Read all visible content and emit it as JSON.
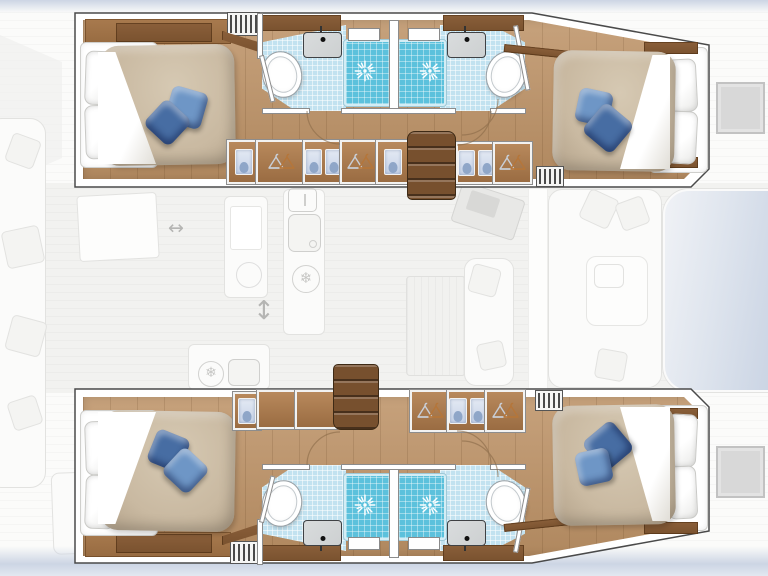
{
  "diagram": {
    "type": "yacht-floor-plan",
    "vessel": "catamaran",
    "orientation": "bow-right",
    "lower_deck": {
      "hulls": [
        {
          "side": "top",
          "cabins": [
            {
              "position": "aft",
              "bed": {
                "white_pillows": 2,
                "blue_throw_pillows": 2,
                "duvet": true
              }
            },
            {
              "position": "forward",
              "bed": {
                "white_pillows": 2,
                "blue_throw_pillows": 2,
                "duvet": true
              }
            }
          ],
          "bathrooms": [
            {
              "serves": "aft",
              "fixtures": [
                "toilet",
                "sink",
                "shower",
                "window"
              ]
            },
            {
              "serves": "forward",
              "fixtures": [
                "toilet",
                "sink",
                "shower",
                "window"
              ]
            }
          ],
          "wardrobes": {
            "hanger_lockers": 3,
            "shirt_shelves": 4
          },
          "companionway_stairs": 1,
          "louver_vents": 2
        },
        {
          "side": "bottom",
          "cabins": [
            {
              "position": "aft",
              "bed": {
                "white_pillows": 2,
                "blue_throw_pillows": 2,
                "duvet": true
              }
            },
            {
              "position": "forward",
              "bed": {
                "white_pillows": 2,
                "blue_throw_pillows": 2,
                "duvet": true
              }
            }
          ],
          "bathrooms": [
            {
              "serves": "aft",
              "fixtures": [
                "toilet",
                "sink",
                "shower",
                "window"
              ]
            },
            {
              "serves": "forward",
              "fixtures": [
                "toilet",
                "sink",
                "shower",
                "window"
              ]
            }
          ],
          "wardrobes": {
            "hanger_lockers": 3,
            "shirt_shelves": 3
          },
          "companionway_stairs": 1,
          "louver_vents": 2
        }
      ]
    },
    "main_deck_faded": {
      "cockpit": [
        "bench seating with scatter cushions",
        "cockpit table",
        "aft sunpad"
      ],
      "galley": [
        "sink unit",
        "round burner",
        "cutlery drawer icon",
        "refrigerator snowflake icon",
        "second sink icon"
      ],
      "salon": [
        "navigation desk",
        "dining table",
        "sofa with cushions",
        "lounge seating with table"
      ],
      "deck": [
        "coachroof",
        "bow deck hatch top",
        "bow deck hatch bottom",
        "sliding-door arrows"
      ]
    },
    "glyphs": {
      "arrow_h": "↔",
      "arrow_v": "↕",
      "snowflake": "❄"
    }
  },
  "palette": {
    "outline": "#4a4a4a",
    "wood_floor": "#bd9266",
    "wood_light": "#a87a4e",
    "wood_dark": "#8a5f3a",
    "stairs_wood": "#77502e",
    "duvet": "#c9b9a1",
    "blue_light": "#6e96c6",
    "blue_dark": "#476da3",
    "bath_tile": "#c2e2f0",
    "shower_tile": "#5cc1dc",
    "fixture": "#cdd0d1",
    "shirt_blue": "#c7d3e8",
    "ghost_fill": "#fbfbfa",
    "ghost_line": "#e2e2e0",
    "faded_icon": "#c7c7c5",
    "water": "#ccd5e4"
  }
}
